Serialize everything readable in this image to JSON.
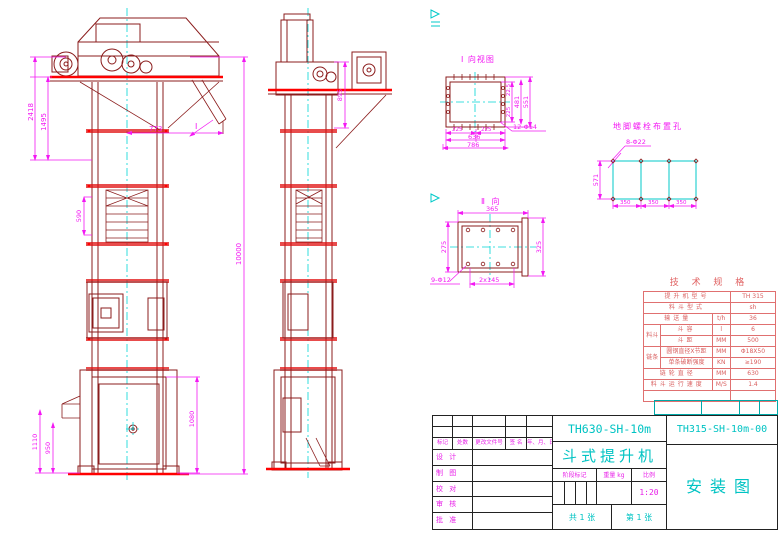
{
  "colors": {
    "outline": "#8b1c1c",
    "accent_red": "#ff0000",
    "dimension": "#ff00ff",
    "centerline": "#00ffff",
    "spec_table": "#e07070",
    "title_cyan": "#00c3c3",
    "title_magenta": "#e81ee8"
  },
  "front_view": {
    "view_mark": "I",
    "dim_2418": "2418",
    "dim_1495": "1495",
    "dim_590": "590",
    "dim_773": "773",
    "dim_10000": "10000",
    "dim_1110": "1110",
    "dim_950": "950",
    "dim_1080": "1080"
  },
  "side_view": {
    "dim_895": "895"
  },
  "view_i": {
    "label": "I 向视图",
    "leader": "12-Φ14",
    "dim_225a": "225",
    "dim_225b": "225",
    "dim_636": "636",
    "dim_786": "786",
    "dim_22_5": "22.5",
    "dim_225v": "225",
    "dim_481": "481",
    "dim_551": "551"
  },
  "view_ii": {
    "label": "Ⅱ 向",
    "leader": "9-Φ12",
    "dim_365": "365",
    "dim_325": "325",
    "dim_275": "275",
    "dim_2x145": "2x145"
  },
  "anchor_plan": {
    "label": "地脚螺栓布置孔",
    "leader": "8-Φ22",
    "dim_350a": "350",
    "dim_350b": "350",
    "dim_350c": "350",
    "dim_571": "571"
  },
  "spec_table": {
    "title": "技 术 规 格",
    "rows": [
      {
        "group": "",
        "label": "提升机型号",
        "unit": "",
        "value": "TH 315"
      },
      {
        "group": "",
        "label": "料斗型式",
        "unit": "",
        "value": "sh"
      },
      {
        "group": "",
        "label": "输送量",
        "unit": "t/h",
        "value": "36"
      },
      {
        "group": "料斗",
        "label": "斗容",
        "unit": "l",
        "value": "6"
      },
      {
        "group": "料斗",
        "label": "斗距",
        "unit": "MM",
        "value": "500"
      },
      {
        "group": "链条",
        "label": "圆钢直径X节距",
        "unit": "MM",
        "value": "Φ18X50"
      },
      {
        "group": "链条",
        "label": "单条破断强度",
        "unit": "KN",
        "value": "≥190"
      },
      {
        "group": "",
        "label": "链轮直径",
        "unit": "MM",
        "value": "630"
      },
      {
        "group": "",
        "label": "料斗运行速度",
        "unit": "M/S",
        "value": "1.4"
      }
    ]
  },
  "title_block": {
    "model": "TH630-SH-10m",
    "product": "斗式提升机",
    "drawing_no": "TH315-SH-10m-00",
    "drawing_name": "安装图",
    "rev_headers": [
      "标记",
      "处数",
      "更改文件号",
      "签 名",
      "年、月、日"
    ],
    "sign_rows": [
      "设 计",
      "制 图",
      "校 对",
      "审 核",
      "批 准"
    ],
    "stage_label": "阶段标记",
    "weight_label": "重量 kg",
    "scale_label": "比例",
    "scale_value": "1:20",
    "sheet_total": "共 1 张",
    "sheet_no": "第 1 张"
  }
}
